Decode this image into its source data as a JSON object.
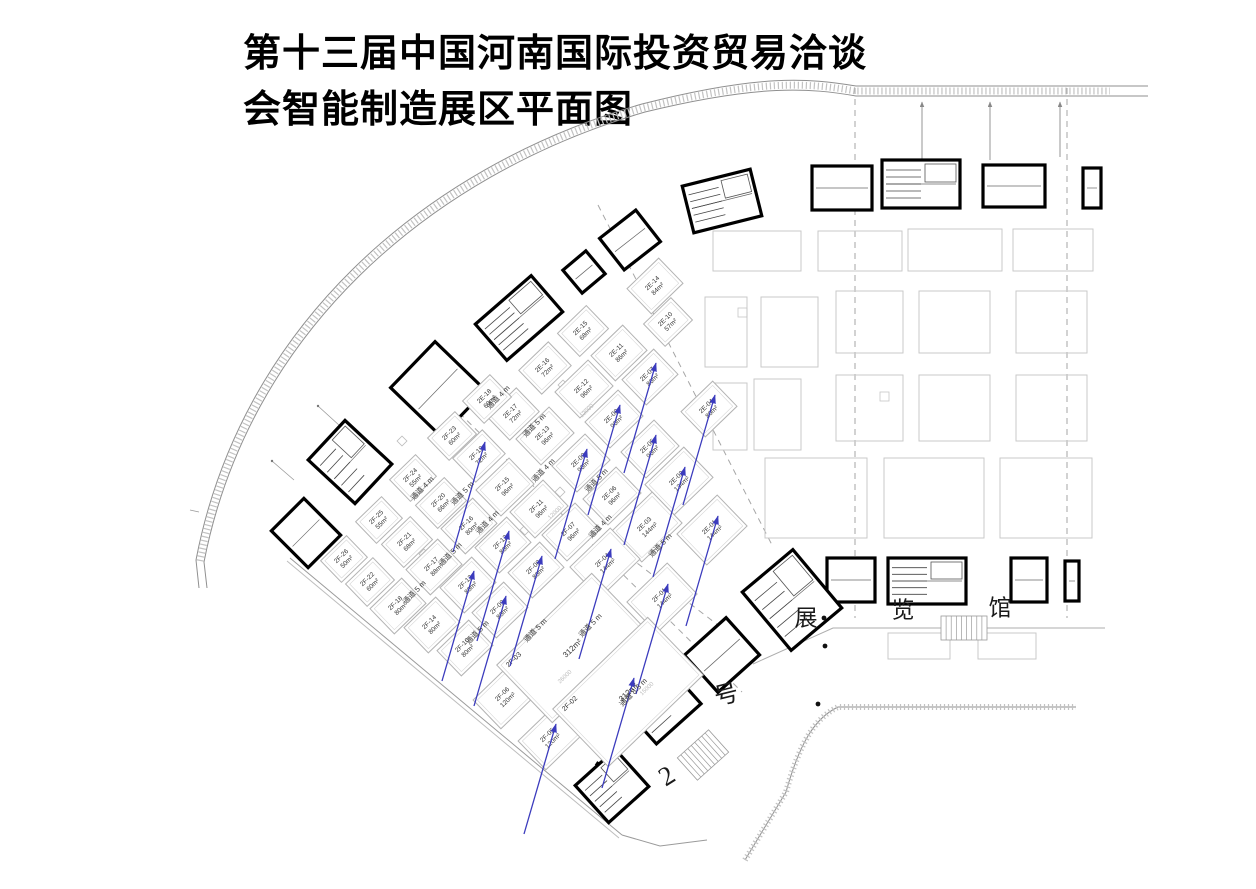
{
  "title": {
    "line1": "第十三届中国河南国际投资贸易洽谈",
    "line2": "会智能制造展区平面图"
  },
  "hall_name": "2号展览馆",
  "hall_chars": [
    {
      "ch": "2",
      "x": 668,
      "y": 778,
      "r": -32,
      "s": 27
    },
    {
      "ch": "号",
      "x": 727,
      "y": 697,
      "r": -14,
      "s": 24
    },
    {
      "ch": "展",
      "x": 806,
      "y": 620,
      "r": 0,
      "s": 23
    },
    {
      "ch": "览",
      "x": 903,
      "y": 612,
      "r": 0,
      "s": 23
    },
    {
      "ch": "馆",
      "x": 1000,
      "y": 610,
      "r": 0,
      "s": 23
    }
  ],
  "booths": [
    {
      "id": "2E-14",
      "area": "84m²",
      "x": 655,
      "y": 286,
      "arrow": false
    },
    {
      "id": "2E-10",
      "area": "57m²",
      "x": 668,
      "y": 322,
      "arrow": false
    },
    {
      "id": "2E-15",
      "area": "68m²",
      "x": 583,
      "y": 331,
      "arrow": false
    },
    {
      "id": "2E-16",
      "area": "72m²",
      "x": 545,
      "y": 368,
      "arrow": false
    },
    {
      "id": "2E-11",
      "area": "86m²",
      "x": 619,
      "y": 353,
      "arrow": false
    },
    {
      "id": "2E-07",
      "area": "86m²",
      "x": 650,
      "y": 377,
      "arrow": true
    },
    {
      "id": "2E-17",
      "area": "72m²",
      "x": 513,
      "y": 414,
      "arrow": false
    },
    {
      "id": "2E-18",
      "area": "60m²",
      "x": 487,
      "y": 399,
      "arrow": false
    },
    {
      "id": "2E-12",
      "area": "96m²",
      "x": 584,
      "y": 389,
      "arrow": false
    },
    {
      "id": "2E-13",
      "area": "96m²",
      "x": 545,
      "y": 436,
      "arrow": false
    },
    {
      "id": "2E-08",
      "area": "96m²",
      "x": 614,
      "y": 419,
      "arrow": true
    },
    {
      "id": "2E-09",
      "area": "96m²",
      "x": 581,
      "y": 463,
      "arrow": true
    },
    {
      "id": "2E-05",
      "area": "96m²",
      "x": 650,
      "y": 449,
      "arrow": true
    },
    {
      "id": "2E-06",
      "area": "96m²",
      "x": 612,
      "y": 496,
      "arrow": false
    },
    {
      "id": "2E-04",
      "area": "80m²",
      "x": 709,
      "y": 409,
      "arrow": true
    },
    {
      "id": "2E-02",
      "area": "134m²",
      "x": 679,
      "y": 481,
      "arrow": true
    },
    {
      "id": "2E-03",
      "area": "144m²",
      "x": 647,
      "y": 527,
      "arrow": false
    },
    {
      "id": "2E-01",
      "area": "144m²",
      "x": 712,
      "y": 530,
      "arrow": true
    },
    {
      "id": "2F-23",
      "area": "60m²",
      "x": 452,
      "y": 436,
      "arrow": false
    },
    {
      "id": "2F-19",
      "area": "72m²",
      "x": 479,
      "y": 456,
      "arrow": true
    },
    {
      "id": "2F-24",
      "area": "55m²",
      "x": 413,
      "y": 478,
      "arrow": false
    },
    {
      "id": "2F-20",
      "area": "66m²",
      "x": 441,
      "y": 503,
      "arrow": false
    },
    {
      "id": "2F-25",
      "area": "55m²",
      "x": 379,
      "y": 520,
      "arrow": false
    },
    {
      "id": "2F-21",
      "area": "68m²",
      "x": 407,
      "y": 542,
      "arrow": false
    },
    {
      "id": "2F-26",
      "area": "50m²",
      "x": 344,
      "y": 559,
      "arrow": false
    },
    {
      "id": "2F-22",
      "area": "60m²",
      "x": 370,
      "y": 582,
      "arrow": false
    },
    {
      "id": "2F-15",
      "area": "96m²",
      "x": 505,
      "y": 487,
      "arrow": false
    },
    {
      "id": "2F-16",
      "area": "80m²",
      "x": 469,
      "y": 526,
      "arrow": false
    },
    {
      "id": "2F-17",
      "area": "88m²",
      "x": 434,
      "y": 567,
      "arrow": false
    },
    {
      "id": "2F-18",
      "area": "80m²",
      "x": 398,
      "y": 606,
      "arrow": false
    },
    {
      "id": "2F-11",
      "area": "96m²",
      "x": 539,
      "y": 509,
      "arrow": false
    },
    {
      "id": "2F-12",
      "area": "88m²",
      "x": 503,
      "y": 545,
      "arrow": true
    },
    {
      "id": "2F-13",
      "area": "88m²",
      "x": 468,
      "y": 585,
      "arrow": true
    },
    {
      "id": "2F-14",
      "area": "80m²",
      "x": 432,
      "y": 625,
      "arrow": false
    },
    {
      "id": "2F-07",
      "area": "96m²",
      "x": 571,
      "y": 532,
      "arrow": false
    },
    {
      "id": "2F-08",
      "area": "88m²",
      "x": 536,
      "y": 570,
      "arrow": true
    },
    {
      "id": "2F-09",
      "area": "88m²",
      "x": 500,
      "y": 610,
      "arrow": true
    },
    {
      "id": "2F-10",
      "area": "80m²",
      "x": 465,
      "y": 648,
      "arrow": false
    },
    {
      "id": "2F-06",
      "area": "120m²",
      "x": 505,
      "y": 697,
      "arrow": false
    },
    {
      "id": "2F-05",
      "area": "120m²",
      "x": 550,
      "y": 738,
      "arrow": true
    },
    {
      "id": "2F-04",
      "area": "144m²",
      "x": 605,
      "y": 563,
      "arrow": true
    },
    {
      "id": "2F-01",
      "area": "144m²",
      "x": 662,
      "y": 598,
      "arrow": true
    },
    {
      "id": "2F-03",
      "area": "312m²",
      "x": 572,
      "y": 648,
      "arrow": false
    },
    {
      "id": "2F-02",
      "area": "312m²",
      "x": 628,
      "y": 692,
      "arrow": true
    }
  ],
  "aisles": [
    {
      "label": "通道 4 m",
      "x": 500,
      "y": 399
    },
    {
      "label": "通道 5 m",
      "x": 536,
      "y": 427
    },
    {
      "label": "通道 4 m",
      "x": 545,
      "y": 472
    },
    {
      "label": "通道 5 m",
      "x": 598,
      "y": 482
    },
    {
      "label": "通道 4 m",
      "x": 602,
      "y": 528
    },
    {
      "label": "通道 5 m",
      "x": 662,
      "y": 547
    },
    {
      "label": "通道 4 m",
      "x": 424,
      "y": 490
    },
    {
      "label": "通道 5 m",
      "x": 464,
      "y": 495
    },
    {
      "label": "通道 4 m",
      "x": 489,
      "y": 524
    },
    {
      "label": "通道 5 m",
      "x": 452,
      "y": 556
    },
    {
      "label": "通道 5 m",
      "x": 416,
      "y": 594
    },
    {
      "label": "通道 5 m",
      "x": 479,
      "y": 634
    },
    {
      "label": "通道 5 m",
      "x": 537,
      "y": 632
    },
    {
      "label": "通道 5 m",
      "x": 592,
      "y": 627
    },
    {
      "label": "通道 8.5 m",
      "x": 635,
      "y": 694
    }
  ],
  "dimension_labels": [
    {
      "text": "26000",
      "x": 566,
      "y": 678
    },
    {
      "text": "15000",
      "x": 648,
      "y": 690
    },
    {
      "text": "12000",
      "x": 588,
      "y": 412
    },
    {
      "text": "12000",
      "x": 556,
      "y": 514
    }
  ],
  "colors": {
    "arrow": "#3b3bbd",
    "wall": "#000000",
    "booth_line": "#b3b3b3",
    "faint_line": "#c9c9c9",
    "dash_line": "#a6a6a6",
    "label_text": "#333333",
    "dim_text": "#bdbdbd"
  }
}
